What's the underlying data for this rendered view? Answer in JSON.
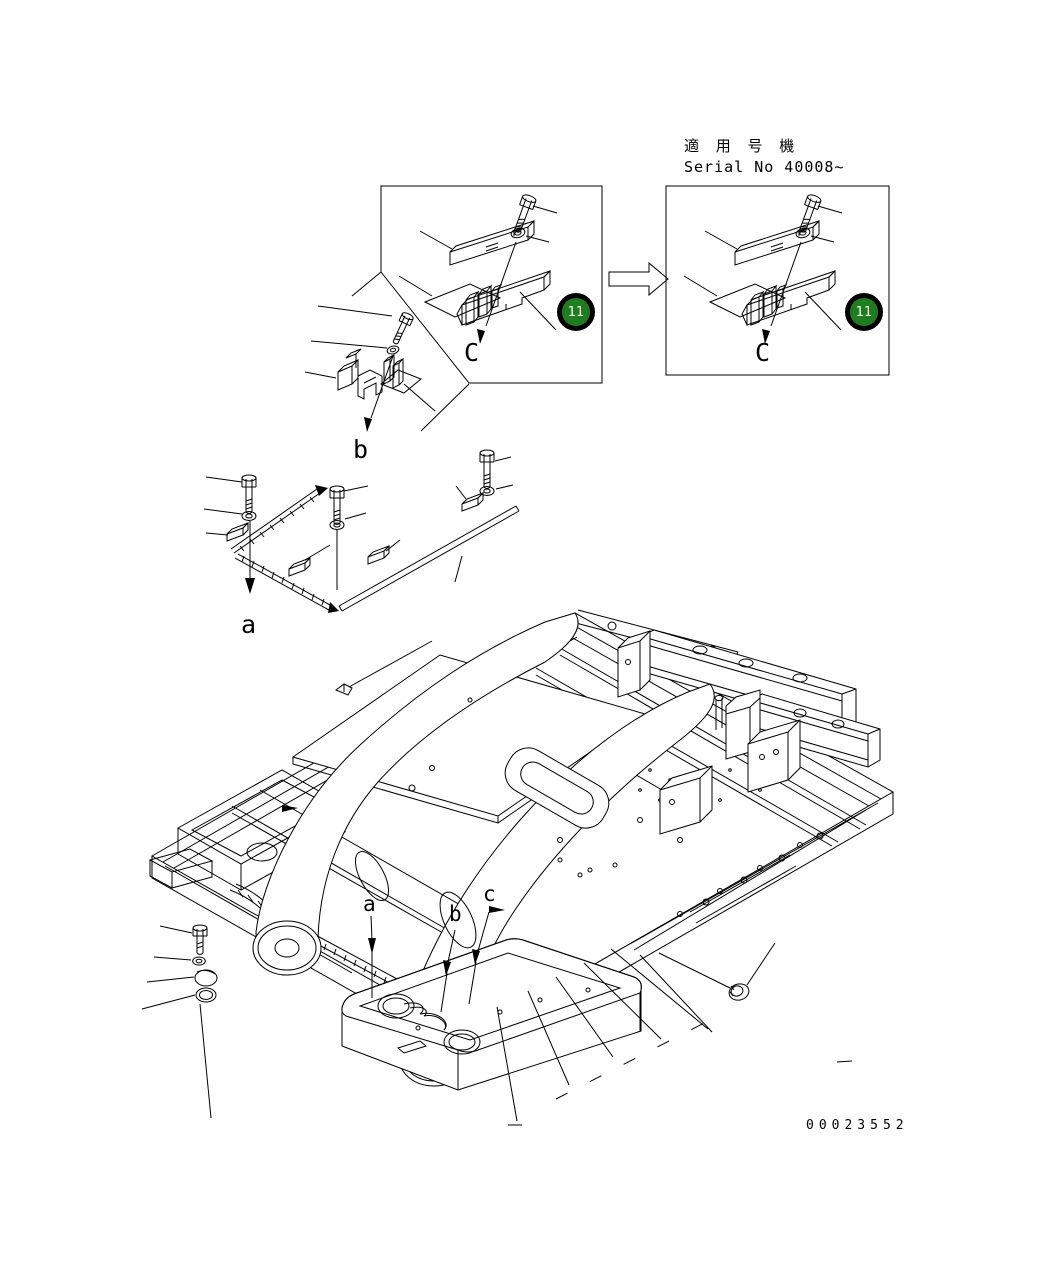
{
  "document": {
    "kind": "machinery-parts-diagram",
    "subject": "revolving frame isometric exploded view"
  },
  "header": {
    "applicable_machines_jp": "適 用 号 機",
    "serial_range": "Serial No 40008~"
  },
  "detail_views": {
    "before": {
      "badge_number": "11",
      "view_label": "C"
    },
    "after": {
      "badge_number": "11",
      "view_label": "C"
    }
  },
  "exploded_views": {
    "view_a_label": "a",
    "view_b_label": "b"
  },
  "frame_reference_labels": {
    "a": "a",
    "b": "b",
    "c": "c"
  },
  "footer": {
    "drawing_number": "00023552"
  },
  "icons": {
    "change_arrow": "hollow-right-arrow"
  },
  "colors": {
    "background": "#ffffff",
    "line": "#000000",
    "badge_fill": "#1e7d1e",
    "badge_ring": "#000000",
    "badge_text": "#ffffff"
  }
}
